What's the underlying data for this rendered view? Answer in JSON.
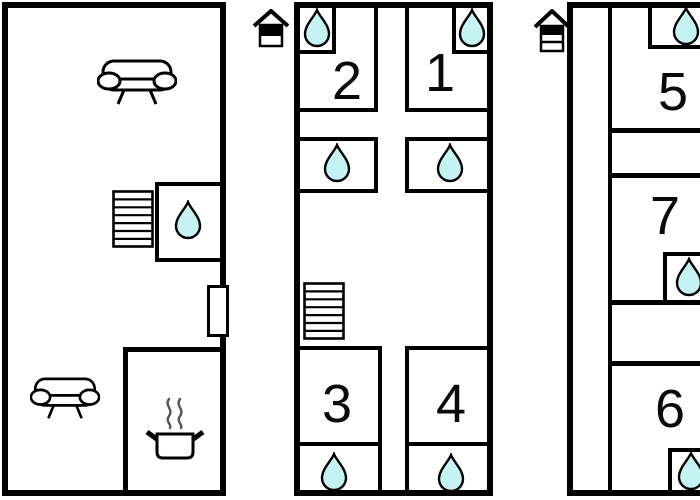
{
  "title": "Floor plan",
  "colors": {
    "wall": "#000000",
    "background": "#ffffff",
    "water_drop_fill": "#c5f2f2"
  },
  "floors": {
    "ground": {
      "icons": {
        "sofa_top": "sofa-icon",
        "sofa_bottom": "sofa-icon",
        "stairs": "stairs-icon",
        "water_drop": "water-drop-icon",
        "cooking_pot": "cooking-pot-icon",
        "window": "window-marker"
      },
      "water_drop_count": 1
    },
    "middle": {
      "level_icon": "house-floor-indicator-icon",
      "rooms": {
        "room1": "1",
        "room2": "2",
        "room3": "3",
        "room4": "4"
      },
      "icons": {
        "stairs": "stairs-icon"
      },
      "water_drop_count": 6
    },
    "top": {
      "level_icon": "house-floor-indicator-icon",
      "rooms": {
        "room5": "5",
        "room6": "6",
        "room7": "7"
      },
      "water_drop_count": 3
    }
  }
}
